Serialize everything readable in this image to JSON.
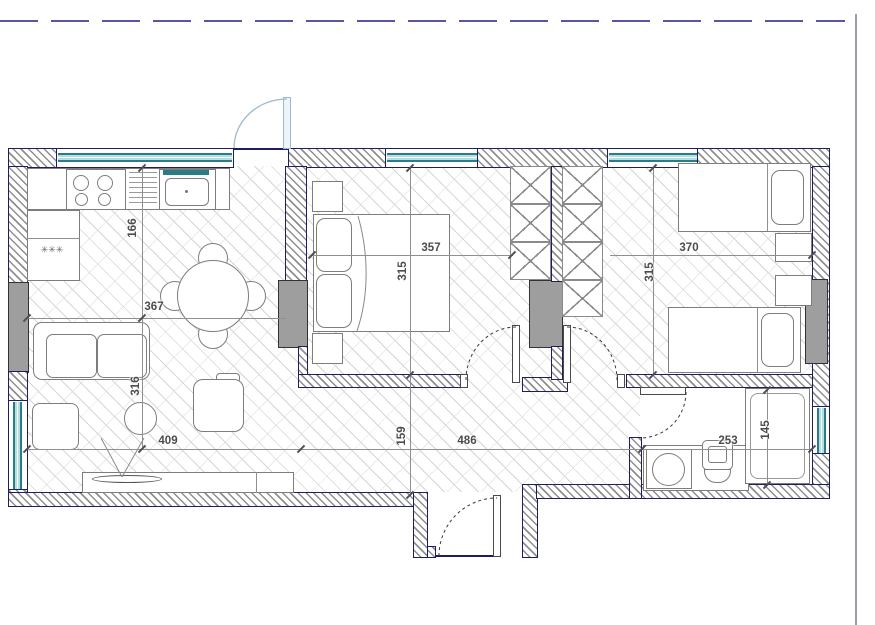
{
  "plan": {
    "type": "apartment-floor-plan",
    "dimensions": [
      {
        "room": "kitchen",
        "axis": "vertical",
        "value": "166"
      },
      {
        "room": "kitchen-living",
        "axis": "horizontal",
        "value": "367"
      },
      {
        "room": "living-room",
        "axis": "vertical",
        "value": "316"
      },
      {
        "room": "living-room",
        "axis": "horizontal",
        "value": "409"
      },
      {
        "room": "master-bedroom",
        "axis": "horizontal",
        "value": "357"
      },
      {
        "room": "master-bedroom",
        "axis": "vertical",
        "value": "315"
      },
      {
        "room": "kids-room",
        "axis": "horizontal",
        "value": "370"
      },
      {
        "room": "kids-room",
        "axis": "vertical",
        "value": "315"
      },
      {
        "room": "hallway",
        "axis": "horizontal",
        "value": "486"
      },
      {
        "room": "hallway",
        "axis": "vertical",
        "value": "159"
      },
      {
        "room": "bathroom",
        "axis": "horizontal",
        "value": "253"
      },
      {
        "room": "bathroom",
        "axis": "vertical",
        "value": "145"
      }
    ],
    "kitchen": {
      "freezer_symbol": "✳✳✳"
    },
    "colors": {
      "wall_outline": "#1d1d60",
      "window_frame": "#2a7d84",
      "window_glass": "#b5dfe2",
      "boundary_line": "#5a55a5",
      "column_fill": "#9e9e9e",
      "entry_door": "#9db8cf",
      "dimension_text": "#4c4c4c"
    }
  }
}
